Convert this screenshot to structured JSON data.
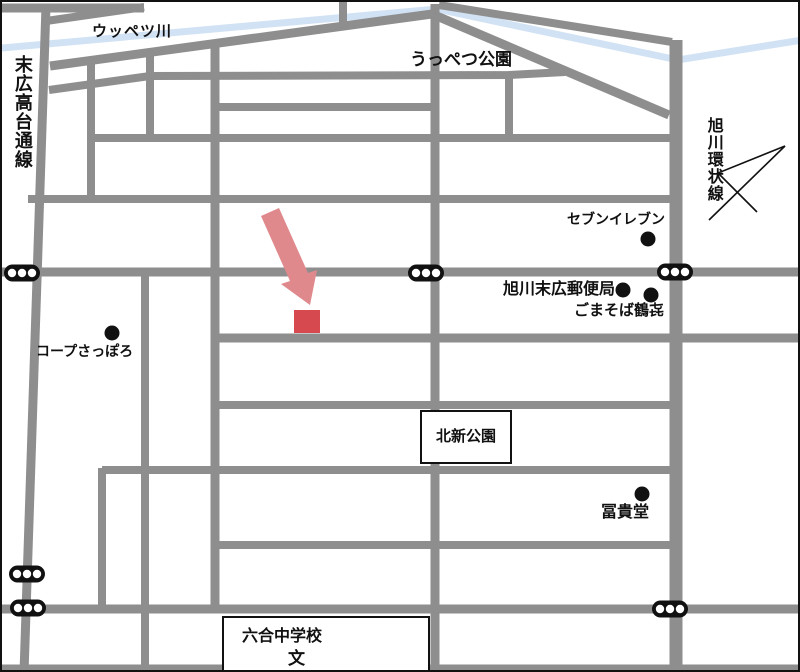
{
  "map": {
    "colors": {
      "road": "#8e8e8e",
      "river": "#d2e2f5",
      "marker": "#d5494f",
      "arrow": "#e0898d",
      "ink": "#111111"
    },
    "labels": {
      "river": "ウッペツ川",
      "road_suehiro": "末広高台通線",
      "park_uppetsu": "うっぺつ公園",
      "road_kanjo": "旭川環状線",
      "seven_eleven": "セブンイレブン",
      "post_office": "旭川末広郵便局",
      "soba": "ごまそば鶴㐂",
      "coop": "コープさっぽろ",
      "park_kitashin": "北新公園",
      "fukido": "冨貴堂",
      "school": "六合中学校",
      "school_mark": "文"
    }
  }
}
